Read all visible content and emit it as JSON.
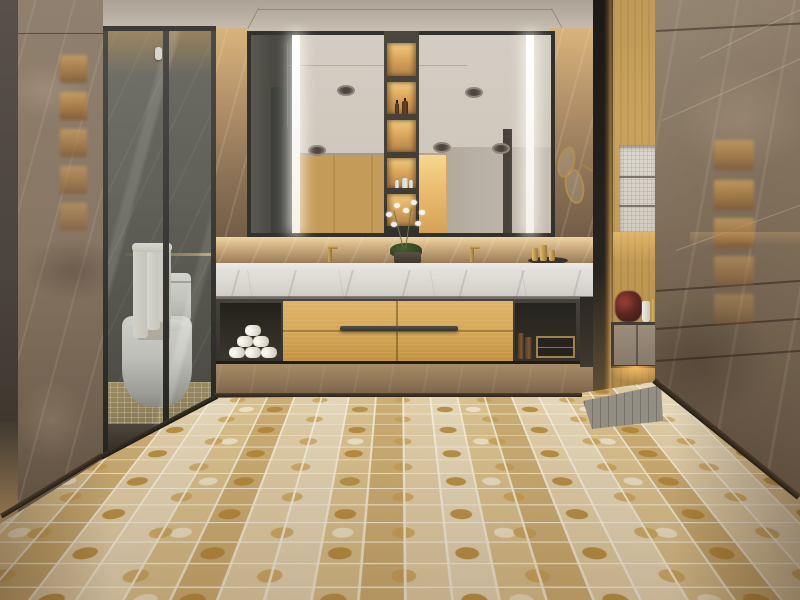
{
  "scene": {
    "type": "photorealistic 3D interior render",
    "room": "luxury hotel bathroom",
    "view": "eye-level one-point perspective facing vanity wall",
    "lighting": "warm concealed LED coves, backlit niches, vertical mirror light strips"
  },
  "palette": {
    "ceiling": "#bcb3a6",
    "brown_marble_wall": "#847261",
    "dark_foreground_wall": "#5a4c3d",
    "oak_wood": "#d5a755",
    "counter_marble": "#e3e0db",
    "cabinet_frame": "#3b3936",
    "mosaic_gold": "#c89c4c",
    "mosaic_cream": "#e9e0c8",
    "mosaic_tan": "#bfa477",
    "grout": "#f2ebd8",
    "led_white": "#f8f7f2",
    "brass_accent": "#a5814a",
    "shower_glass": "#626c64",
    "towel_white": "#efece4"
  },
  "regions": {
    "ceiling": {
      "recessed_tray": true,
      "reflected_downlights": 5
    },
    "vanity": {
      "mirror": "full-width framed mirror reflecting ceiling, oak wall and lit doorway",
      "led_strips": 2,
      "niche_column": {
        "niches": 5,
        "contents": [
          "empty",
          "2 amber bottles",
          "empty",
          "3 white bottles",
          "empty"
        ]
      },
      "countertop": "white Carrara-style marble slab",
      "faucets": 2,
      "centerpiece": "white orchid in dark pot",
      "counter_tray": "dark tray with gold bottles",
      "drawers": {
        "material": "golden oak",
        "columns": 2,
        "rows": 2,
        "handle": "long dark bar"
      },
      "open_shelves": {
        "left": "pyramid of rolled white towels",
        "right": "amber bottles and brass-framed box"
      }
    },
    "shower": {
      "glass_panels": 3,
      "towels": "white towels on brass bar",
      "toilet": "white one-piece",
      "interior": "dark grey marble, warm cove glow"
    },
    "left_wall": {
      "material": "brown emperador marble",
      "reflection": "backlit amber niches"
    },
    "right_wall": {
      "material": "brown emperador marble slab",
      "joints": 4,
      "reflection": "backlit amber niches and lit cove"
    },
    "right_bay": {
      "divider": "dark panel with brass trim",
      "wood_panel": "oak",
      "white_mosaic_niche_shelves": 3,
      "floating_cabinet": "taupe with warm underlight",
      "decor": [
        "red flower arrangement",
        "white vase",
        "gold pump bottle"
      ]
    },
    "floor": {
      "type": "mosaic tile",
      "motif": "gold leaf-print, cream and tan squares",
      "platform": "grey tile pad under right cabinet"
    }
  },
  "render_params": {
    "mirror_ceiling_lights": [
      [
        86,
        50
      ],
      [
        214,
        52
      ],
      [
        57,
        110
      ],
      [
        182,
        107
      ],
      [
        241,
        108
      ]
    ],
    "center_niches": [
      {
        "y": 12,
        "h": 33,
        "items": []
      },
      {
        "y": 51,
        "h": 32,
        "items": [
          "amber",
          "amber"
        ]
      },
      {
        "y": 89,
        "h": 32,
        "items": []
      },
      {
        "y": 127,
        "h": 30,
        "items": [
          "white",
          "white",
          "white"
        ]
      },
      {
        "y": 163,
        "h": 32,
        "items": []
      }
    ],
    "towel_rows": [
      {
        "y": 347,
        "xs": [
          229,
          245,
          261
        ]
      },
      {
        "y": 336,
        "xs": [
          237,
          253
        ]
      },
      {
        "y": 325,
        "xs": [
          245
        ]
      }
    ],
    "amber_left": {
      "x": 60,
      "w": 27,
      "h": 28,
      "ys": [
        55,
        92,
        129,
        166,
        203
      ],
      "ops": [
        0.75,
        0.8,
        0.7,
        0.6,
        0.5
      ]
    },
    "amber_right": {
      "x": 714,
      "w": 40,
      "h": 30,
      "ys": [
        140,
        180,
        218,
        256,
        294
      ],
      "ops": [
        0.65,
        0.75,
        0.7,
        0.5,
        0.38
      ]
    },
    "right_wall_joints": [
      {
        "x": 656,
        "y": 30,
        "w": 146,
        "r": -3
      },
      {
        "x": 656,
        "y": 290,
        "w": 146,
        "r": -4
      },
      {
        "x": 656,
        "y": 328,
        "w": 146,
        "r": -4
      },
      {
        "x": 656,
        "y": 360,
        "w": 146,
        "r": -4
      }
    ],
    "right_wall_veins": [
      {
        "x": 662,
        "y": 120,
        "w": 185,
        "r": -24
      },
      {
        "x": 676,
        "y": 250,
        "w": 160,
        "r": -20
      },
      {
        "x": 700,
        "y": 58,
        "w": 150,
        "r": -26
      }
    ],
    "gold_bottles": [
      {
        "x": 532,
        "w": 6,
        "h": 13
      },
      {
        "x": 540,
        "w": 7,
        "h": 16
      },
      {
        "x": 549,
        "w": 6,
        "h": 11
      }
    ],
    "orchid_dots": [
      [
        386,
        212
      ],
      [
        394,
        203
      ],
      [
        403,
        208
      ],
      [
        411,
        200
      ],
      [
        419,
        210
      ],
      [
        415,
        221
      ],
      [
        391,
        222
      ]
    ],
    "amber_jars": [
      {
        "x": 518,
        "y": 333,
        "w": 6,
        "h": 26
      },
      {
        "x": 525,
        "y": 337,
        "w": 7,
        "h": 22
      }
    ],
    "niche_shelves_y": [
      176,
      205
    ]
  }
}
